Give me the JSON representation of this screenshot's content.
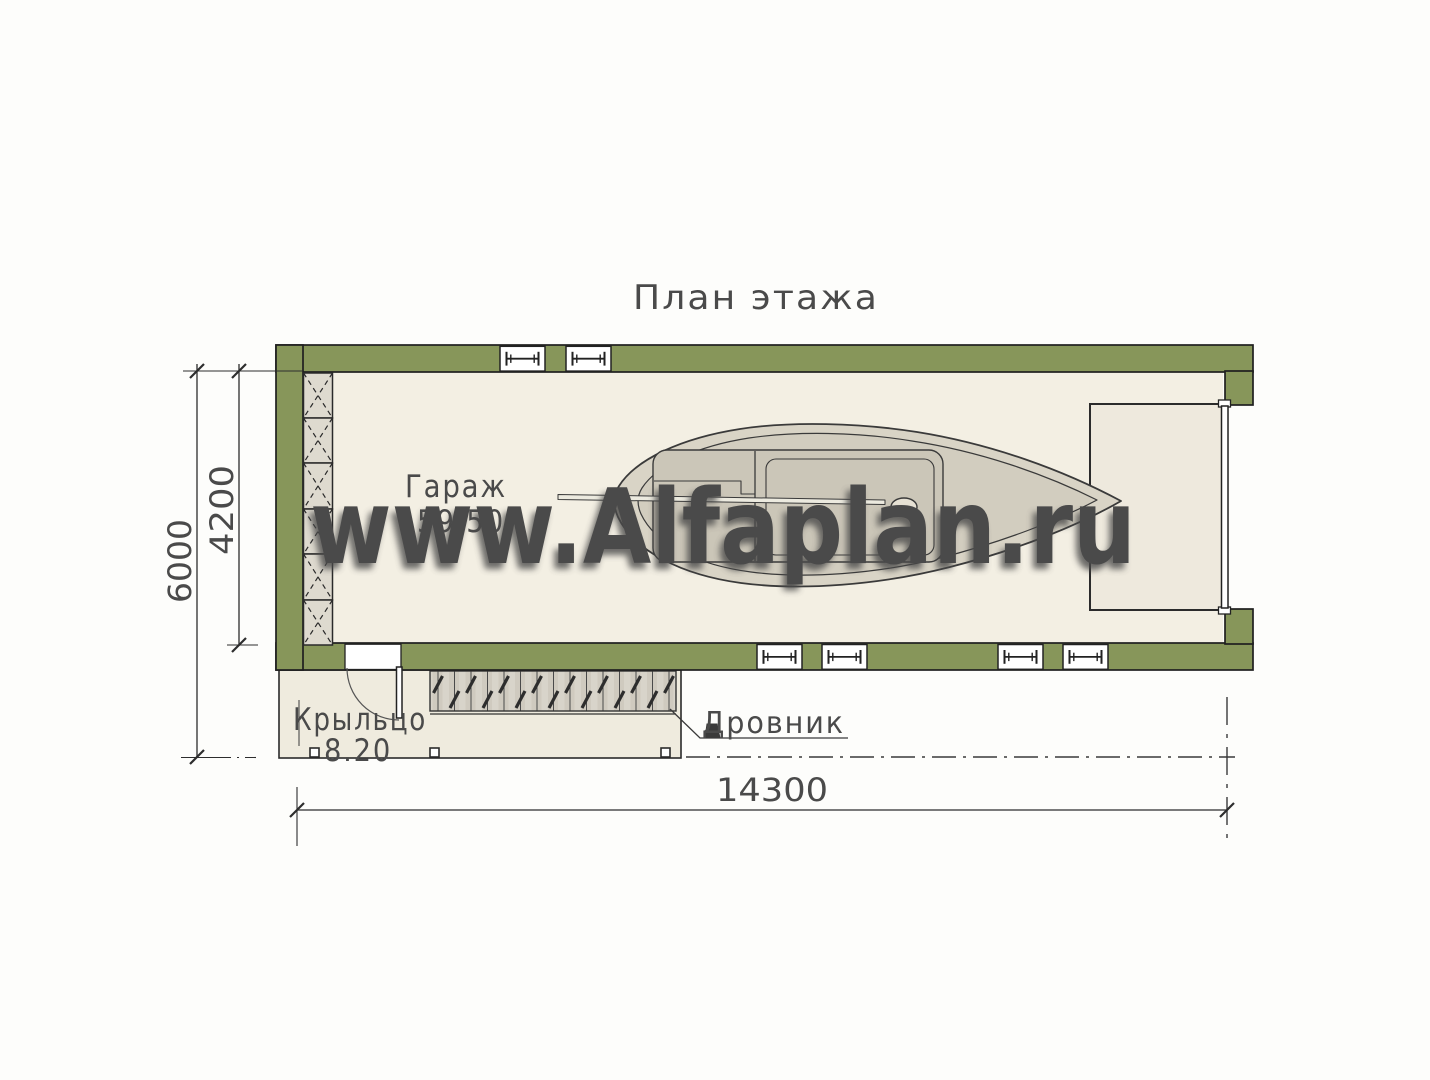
{
  "title": "План этажа",
  "watermark": "www.Alfaplan.ru",
  "rooms": {
    "garage": {
      "name": "Гараж",
      "area": "59.50"
    },
    "porch": {
      "name": "Крыльцо",
      "area": "8.20"
    }
  },
  "labels": {
    "woodshed": "Дровник"
  },
  "dimensions": {
    "overall_height": "6000",
    "inner_height": "4200",
    "overall_width": "14300"
  },
  "colors": {
    "wall_green": "#87965a",
    "outline": "#262626",
    "garage_floor": "#f3efe3",
    "porch_floor": "#efebde",
    "hatch_fill": "#dedacf",
    "woodpile_fill": "#d8d4ca",
    "boat_deck": "#d9d4c6",
    "boat_inner": "#d2cdbf",
    "boat_cabin": "#cbc6b8",
    "watermark_text": "#ffffff"
  }
}
